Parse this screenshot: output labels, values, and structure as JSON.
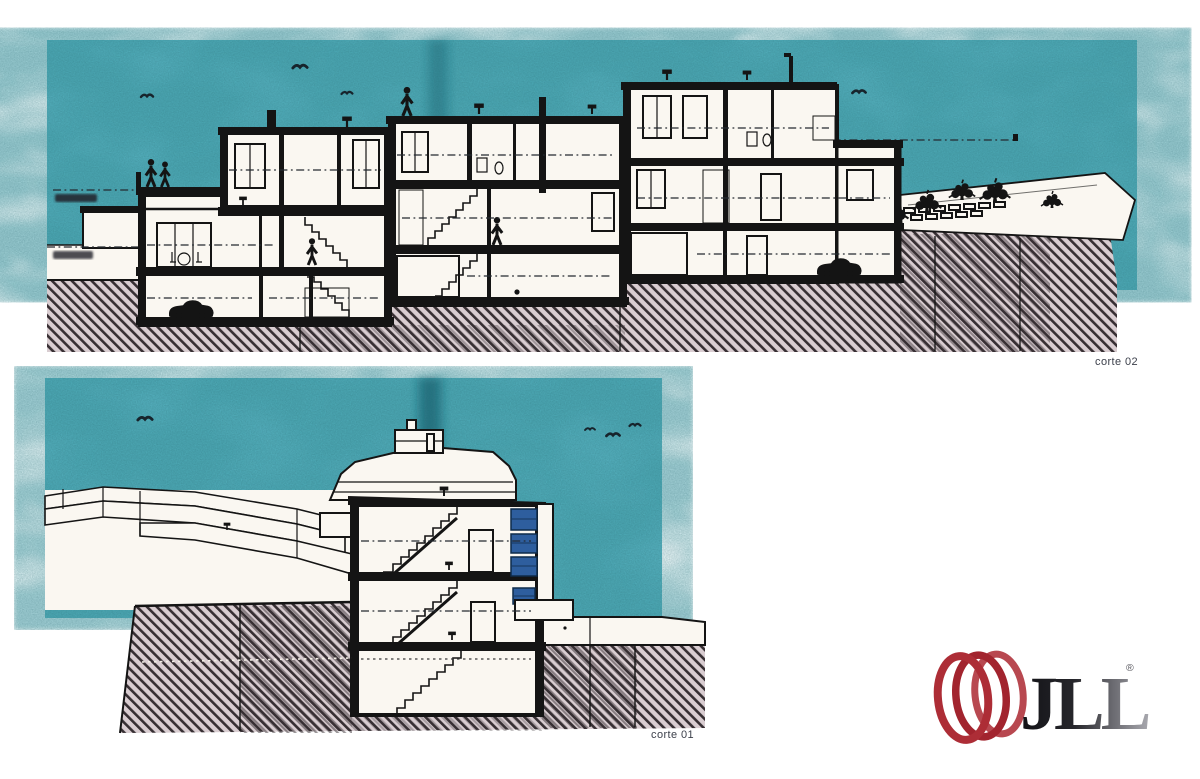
{
  "page": {
    "background_color": "#ffffff"
  },
  "drawings": [
    {
      "id": "corte-02",
      "label": "corte 02",
      "type": "building-cross-section"
    },
    {
      "id": "corte-01",
      "label": "corte 01",
      "type": "building-cross-section"
    }
  ],
  "logo": {
    "wordmark": "JLL",
    "registered_mark": "®"
  },
  "colors": {
    "page_bg": "#ffffff",
    "sky_teal": "#58b2c0",
    "fold_teal": "#14606f",
    "paper_white": "#faf7f1",
    "ink": "#141414",
    "hatch_bg": "#d9cdd1",
    "hatch_ink": "#372f33",
    "window_blue": "#2e5e9e",
    "logo_red": "#a2242e",
    "label_ink": "#3b3f4a"
  }
}
